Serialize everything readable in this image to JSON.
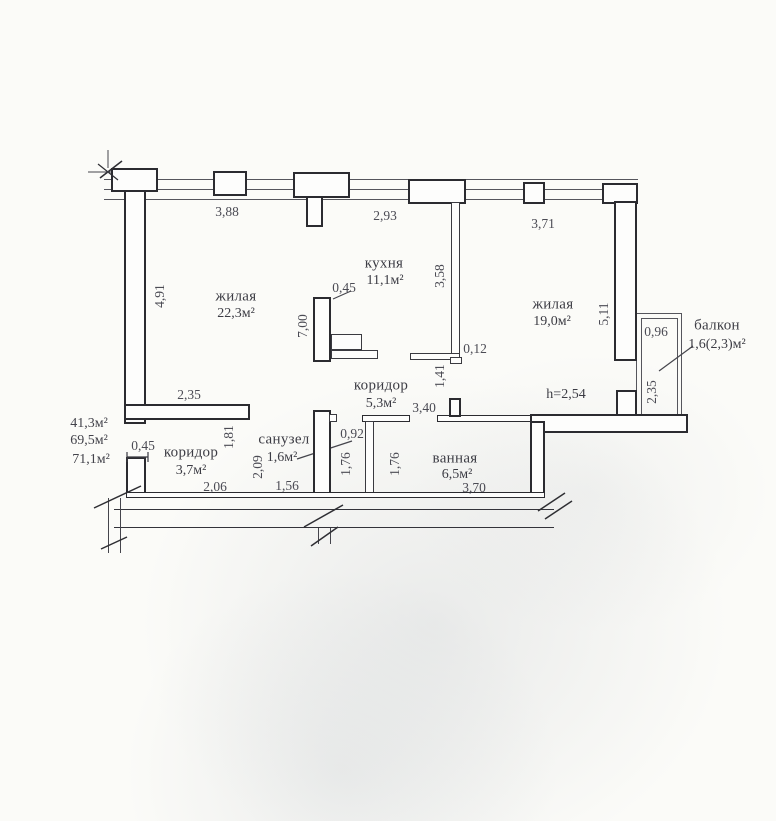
{
  "colors": {
    "paper": "#fbfbf8",
    "ink": "#2b2b30",
    "text": "#3c3c44"
  },
  "rooms": [
    {
      "id": "living-1",
      "name": "жилая",
      "area": "22,3м²"
    },
    {
      "id": "kitchen",
      "name": "кухня",
      "area": "11,1м²"
    },
    {
      "id": "living-2",
      "name": "жилая",
      "area": "19,0м²"
    },
    {
      "id": "corridor-main",
      "name": "коридор",
      "area": "5,3м²"
    },
    {
      "id": "wc",
      "name": "санузел",
      "area": "1,6м²"
    },
    {
      "id": "bathroom",
      "name": "ванная",
      "area": "6,5м²"
    },
    {
      "id": "corridor-entry",
      "name": "коридор",
      "area": "3,7м²"
    },
    {
      "id": "balcony",
      "name": "балкон",
      "area": "1,6(2,3)м²"
    }
  ],
  "area_summary": [
    "41,3м²",
    "69,5м²",
    "71,1м²"
  ],
  "ceiling_height": "h=2,54",
  "dims": {
    "h": [
      "3,88",
      "2,93",
      "3,71",
      "0,45",
      "0,12",
      "2,35",
      "3,40",
      "0,96",
      "0,45",
      "2,06",
      "1,56",
      "0,92",
      "3,70"
    ],
    "v": [
      "4,91",
      "7,00",
      "3,58",
      "5,11",
      "1,41",
      "2,35",
      "1,81",
      "2,09",
      "1,76",
      "1,76"
    ]
  }
}
